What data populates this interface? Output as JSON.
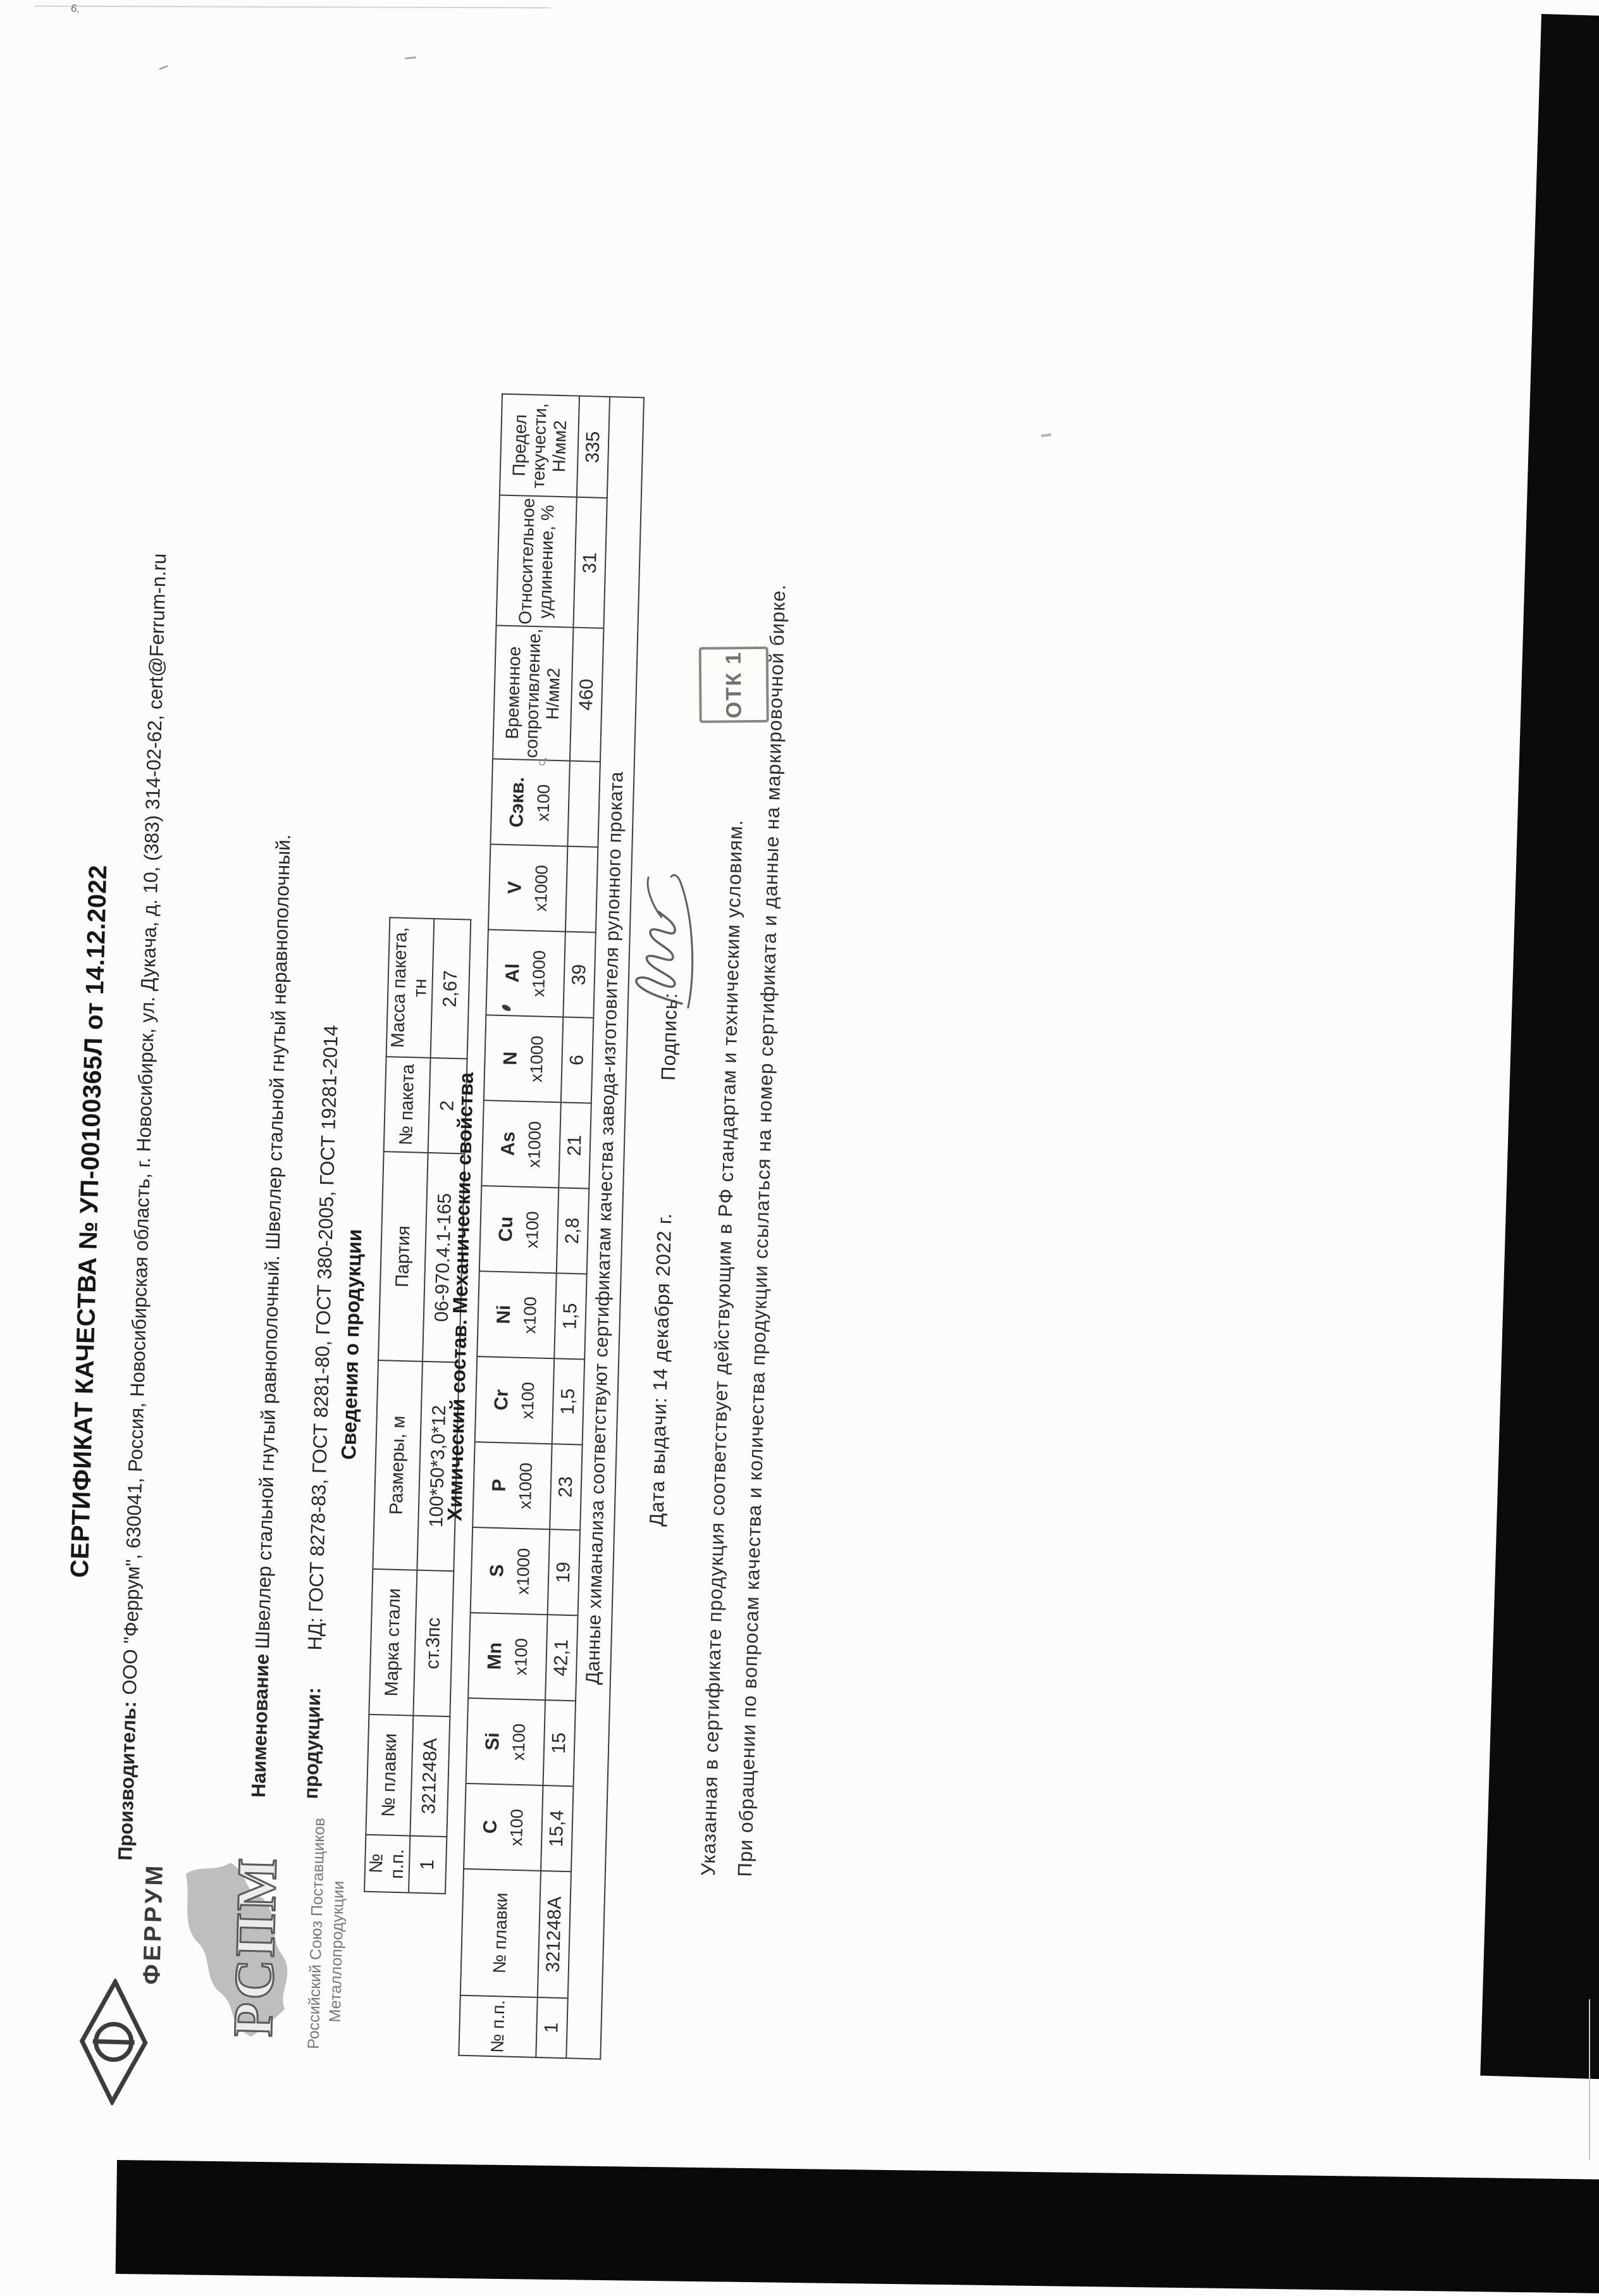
{
  "certificate": {
    "title": "СЕРТИФИКАТ  КАЧЕСТВА  №  УП-00100365Л  от 14.12.2022",
    "producer_label": "Производитель:",
    "producer": "ООО \"Феррум\", 630041, Россия, Новосибирская область, г. Новосибирск, ул. Дукача, д. 10, (383) 314-02-62, cert@Ferrum-n.ru",
    "product_name_label_1": "Наименование",
    "product_name_label_2": "продукции:",
    "product_name": "Швеллер стальной гнутый равнополочный. Швеллер стальной гнутый неравнополочный.",
    "nd": "НД: ГОСТ 8278-83, ГОСТ 8281-80, ГОСТ 380-2005, ГОСТ 19281-2014",
    "info_section_title": "Сведения о продукции",
    "chem_section_title": "Химический состав. Механические свойства",
    "date_line": "Дата выдачи: 14 декабря 2022 г.",
    "signature_label": "Подпись:",
    "stamp_text": "ОТК 1",
    "footer_line1": "Указанная в сертификате продукция соответствует действующим в РФ стандартам и техническим условиям.",
    "footer_line2": "При обращении по вопросам качества и количества продукции ссылаться на номер сертификата и данные на маркировочной бирке."
  },
  "logos": {
    "ferrum_text": "ФЕРРУМ",
    "rspm_text": "РСПМ",
    "union_line1": "Российский Союз Поставщиков",
    "union_line2": "Металлопродукции"
  },
  "info_table": {
    "headers": [
      "№ п.п.",
      "№ плавки",
      "Марка стали",
      "Размеры, м",
      "Партия",
      "№ пакета",
      "Масса пакета, тн"
    ],
    "widths": [
      90,
      190,
      230,
      330,
      330,
      150,
      220
    ],
    "rows": [
      [
        "1",
        "321248А",
        "ст.3пс",
        "100*50*3,0*12",
        "06-970.4.1-165",
        "2",
        "2,67"
      ]
    ]
  },
  "chem_table": {
    "columns": [
      {
        "label": "№ п.п.",
        "mult": ""
      },
      {
        "label": "№ плавки",
        "mult": ""
      },
      {
        "label": "C",
        "mult": "х100"
      },
      {
        "label": "Si",
        "mult": "х100"
      },
      {
        "label": "Mn",
        "mult": "х100"
      },
      {
        "label": "S",
        "mult": "х1000"
      },
      {
        "label": "P",
        "mult": "х1000"
      },
      {
        "label": "Cr",
        "mult": "х100"
      },
      {
        "label": "Ni",
        "mult": "х100"
      },
      {
        "label": "Cu",
        "mult": "х100"
      },
      {
        "label": "As",
        "mult": "х1000"
      },
      {
        "label": "N",
        "mult": "х1000"
      },
      {
        "label": "Al",
        "mult": "х1000"
      },
      {
        "label": "V",
        "mult": "х1000"
      },
      {
        "label": "Сэкв.",
        "mult": "х100"
      },
      {
        "label": "Временное сопротивление, Н/мм2",
        "mult": ""
      },
      {
        "label": "Относительное удлинение, %",
        "mult": ""
      },
      {
        "label": "Предел текучести, Н/мм2",
        "mult": ""
      }
    ],
    "widths": [
      95,
      200,
      135,
      135,
      135,
      135,
      135,
      135,
      135,
      135,
      135,
      135,
      135,
      135,
      135,
      150,
      150,
      160
    ],
    "rows": [
      [
        "1",
        "321248А",
        "15,4",
        "15",
        "42,1",
        "19",
        "23",
        "1,5",
        "1,5",
        "2,8",
        "21",
        "6",
        "39",
        "",
        "",
        "460",
        "31",
        "335"
      ]
    ],
    "note": "Данные химанализа соответствуют сертификатам качества завода-изготовителя рулонного проката"
  }
}
